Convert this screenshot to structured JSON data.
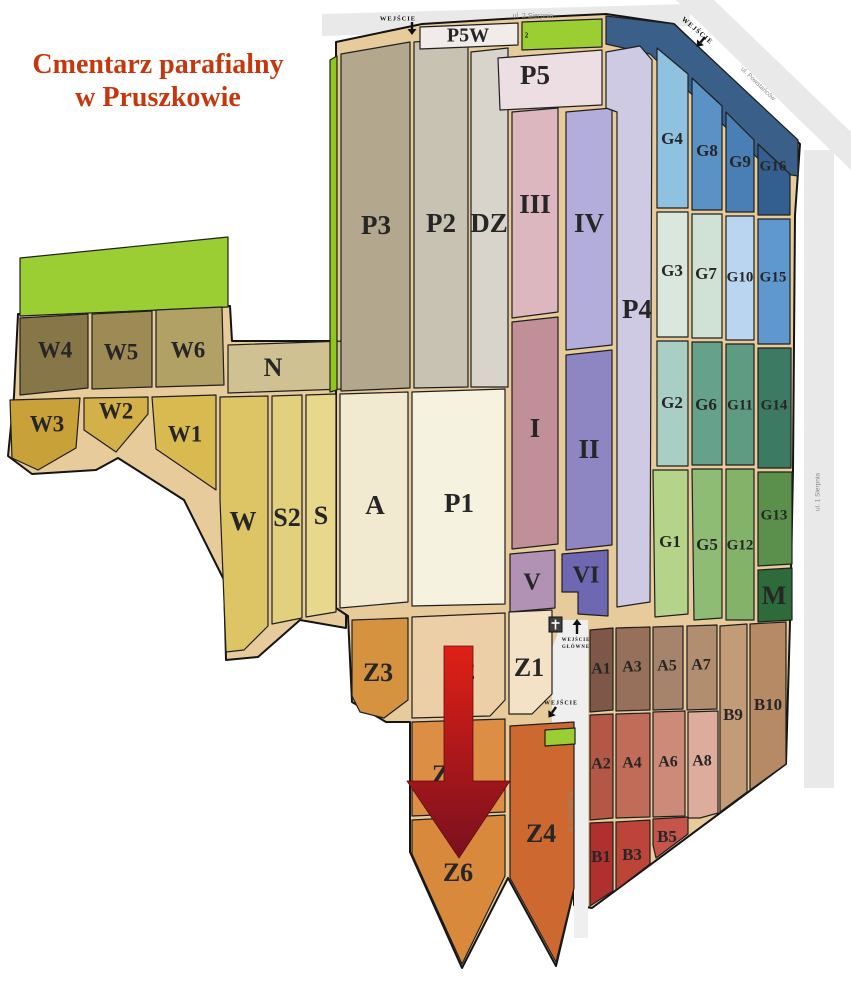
{
  "title": {
    "line1": "Cmentarz parafialny",
    "line2": "w Pruszkowie",
    "color": "#c5380e"
  },
  "map": {
    "road_color": "#e9e9e9",
    "inner_road_color": "#efefef",
    "path_color": "#e8cb9b",
    "outline_color": "#141414",
    "section_stroke": "#1f1f1f",
    "label_color": "#262626",
    "arrow_gradient": {
      "top": "#e02016",
      "bottom": "#7a101e"
    },
    "roads": [
      {
        "id": "2-sierpnia",
        "poly": "322,14 690,4 690,26 322,36"
      },
      {
        "id": "powstancow",
        "poly": "676,0 714,0 851,132 851,170"
      },
      {
        "id": "1-sierpnia",
        "poly": "804,150 834,150 834,788 804,788"
      }
    ],
    "inner_road": {
      "id": "cmentarna",
      "poly": "563,620 588,620 588,938 574,938 574,728 552,728 552,648"
    },
    "base": [
      {
        "id": "base-left-lobe",
        "poly": "14,396 18,314 230,306 232,341 346,341 346,628 300,620 258,657 226,660 224,580 184,500 118,458 96,470 32,474 8,456"
      },
      {
        "id": "base-main-lobe",
        "poly": "336,42 422,24 520,18 606,14 674,24 800,144 795,215 793,470 790,622 786,764 592,908 574,905 574,890 556,966 508,878 462,968 410,852 410,722 386,722 352,702 348,616 336,608"
      }
    ],
    "sections": [
      {
        "id": "green-west",
        "label": "",
        "poly": "20,258 228,237 228,307 20,316",
        "fill": "#9bce32"
      },
      {
        "id": "W4",
        "label": "W4",
        "poly": "20,318 88,314 88,388 20,395",
        "fill": "#877647",
        "lx": 55,
        "ly": 352,
        "fs": 23
      },
      {
        "id": "W5",
        "label": "W5",
        "poly": "92,314 152,311 152,387 92,389",
        "fill": "#9d8a54",
        "lx": 121,
        "ly": 354,
        "fs": 23
      },
      {
        "id": "W6",
        "label": "W6",
        "poly": "156,310 222,307 224,385 156,387",
        "fill": "#b1a164",
        "lx": 188,
        "ly": 352,
        "fs": 23
      },
      {
        "id": "N",
        "label": "N",
        "poly": "228,345 344,341 344,389 228,393",
        "fill": "#cfc191",
        "lx": 273,
        "ly": 370,
        "fs": 26
      },
      {
        "id": "W3",
        "label": "W3",
        "poly": "10,400 80,398 76,448 38,470 12,458",
        "fill": "#c8a138",
        "lx": 47,
        "ly": 426,
        "fs": 23
      },
      {
        "id": "W2",
        "label": "W2",
        "poly": "84,398 148,397 148,414 116,452 84,430",
        "fill": "#d3b048",
        "lx": 116,
        "ly": 413,
        "fs": 23
      },
      {
        "id": "W1",
        "label": "W1",
        "poly": "152,397 216,395 216,490 156,449",
        "fill": "#d9ba50",
        "lx": 185,
        "ly": 436,
        "fs": 23
      },
      {
        "id": "W",
        "label": "W",
        "poly": "220,397 268,396 268,626 244,650 226,652 220,500",
        "fill": "#ddc465",
        "lx": 243,
        "ly": 524,
        "fs": 27
      },
      {
        "id": "S2",
        "label": "S2",
        "poly": "272,396 302,395 302,618 272,624",
        "fill": "#e3d07c",
        "lx": 287,
        "ly": 520,
        "fs": 26
      },
      {
        "id": "S",
        "label": "S",
        "poly": "306,395 336,394 336,612 306,617",
        "fill": "#e8d88c",
        "lx": 321,
        "ly": 518,
        "fs": 26
      },
      {
        "id": "green-p3",
        "label": "",
        "poly": "330,60 337,56 337,390 330,392",
        "fill": "#8ec81e"
      },
      {
        "id": "P3",
        "label": "P3",
        "poly": "341,54 410,42 410,388 341,391",
        "fill": "#b3a88d",
        "lx": 376,
        "ly": 228,
        "fs": 27
      },
      {
        "id": "P2",
        "label": "P2",
        "poly": "414,42 468,38 468,387 414,388",
        "fill": "#c8c2b2",
        "lx": 441,
        "ly": 226,
        "fs": 27
      },
      {
        "id": "DZ",
        "label": "DZ",
        "poly": "471,52 508,48 508,387 471,387",
        "fill": "#d8d4cb",
        "lx": 489,
        "ly": 226,
        "fs": 27
      },
      {
        "id": "P5W",
        "label": "P5W",
        "poly": "420,27 518,23 518,45 420,49",
        "fill": "#f1ece9",
        "lx": 468,
        "ly": 37,
        "fs": 20
      },
      {
        "id": "P5",
        "label": "P5",
        "poly": "498,58 602,50 602,105 500,110",
        "fill": "#ecdee2",
        "lx": 535,
        "ly": 78,
        "fs": 27
      },
      {
        "id": "green-top",
        "label": "",
        "poly": "522,22 602,19 602,47 522,50",
        "fill": "#9bce32"
      },
      {
        "id": "navy-band",
        "label": "",
        "poly": "606,16 674,24 798,140 798,176 772,172 650,54 606,44",
        "fill": "#3a5f88"
      },
      {
        "id": "III",
        "label": "III",
        "poly": "512,112 558,108 558,312 512,318",
        "fill": "#dcb7bf",
        "lx": 535,
        "ly": 207,
        "fs": 27
      },
      {
        "id": "I",
        "label": "I",
        "poly": "512,322 558,317 558,544 512,549",
        "fill": "#c18f98",
        "lx": 535,
        "ly": 431,
        "fs": 27
      },
      {
        "id": "IV",
        "label": "IV",
        "poly": "566,112 612,108 612,345 566,350",
        "fill": "#b2adda",
        "lx": 589,
        "ly": 226,
        "fs": 27
      },
      {
        "id": "II",
        "label": "II",
        "poly": "566,355 612,350 612,545 566,550",
        "fill": "#8d86c2",
        "lx": 589,
        "ly": 452,
        "fs": 27
      },
      {
        "id": "P4",
        "label": "P4",
        "poly": "606,52 640,46 652,60 650,602 617,607 617,112 606,108",
        "fill": "#cecae4",
        "lx": 637,
        "ly": 312,
        "fs": 27
      },
      {
        "id": "V",
        "label": "V",
        "poly": "510,554 555,550 555,608 510,612",
        "fill": "#b191b4",
        "lx": 532,
        "ly": 584,
        "fs": 24
      },
      {
        "id": "VI",
        "label": "VI",
        "poly": "562,554 608,550 608,616 578,614 578,592 562,592",
        "fill": "#6e67b2",
        "lx": 586,
        "ly": 577,
        "fs": 24
      },
      {
        "id": "A",
        "label": "A",
        "poly": "340,394 408,392 408,602 340,608",
        "fill": "#f1ead0",
        "lx": 375,
        "ly": 508,
        "fs": 27
      },
      {
        "id": "P1",
        "label": "P1",
        "poly": "412,392 505,389 505,604 412,606",
        "fill": "#f6f2e0",
        "lx": 459,
        "ly": 506,
        "fs": 27
      },
      {
        "id": "G4",
        "label": "G4",
        "poly": "657,48 688,74 688,208 657,208",
        "fill": "#8fc1e1",
        "lx": 672,
        "ly": 140,
        "fs": 17
      },
      {
        "id": "G8",
        "label": "G8",
        "poly": "692,78 722,106 722,210 692,210",
        "fill": "#5a92c5",
        "lx": 707,
        "ly": 152,
        "fs": 17
      },
      {
        "id": "G9",
        "label": "G9",
        "poly": "726,112 754,140 754,212 726,212",
        "fill": "#4a7fb6",
        "lx": 740,
        "ly": 163,
        "fs": 17
      },
      {
        "id": "G16",
        "label": "G16",
        "poly": "758,144 790,174 790,215 758,215",
        "fill": "#335f90",
        "lx": 773,
        "ly": 167,
        "fs": 15
      },
      {
        "id": "G3",
        "label": "G3",
        "poly": "657,212 688,212 688,337 657,337",
        "fill": "#d9e7dd",
        "lx": 672,
        "ly": 272,
        "fs": 17
      },
      {
        "id": "G7",
        "label": "G7",
        "poly": "692,214 722,214 722,338 692,338",
        "fill": "#d0e1d5",
        "lx": 706,
        "ly": 275,
        "fs": 17
      },
      {
        "id": "G10",
        "label": "G10",
        "poly": "726,216 754,216 754,340 726,340",
        "fill": "#b9d5ef",
        "lx": 740,
        "ly": 278,
        "fs": 15
      },
      {
        "id": "G15",
        "label": "G15",
        "poly": "758,219 790,219 790,344 758,344",
        "fill": "#5f98ce",
        "lx": 773,
        "ly": 278,
        "fs": 15
      },
      {
        "id": "G2",
        "label": "G2",
        "poly": "657,341 688,341 688,466 657,466",
        "fill": "#a9cfc4",
        "lx": 672,
        "ly": 404,
        "fs": 17
      },
      {
        "id": "G6",
        "label": "G6",
        "poly": "692,342 722,342 722,465 692,465",
        "fill": "#66a18c",
        "lx": 706,
        "ly": 406,
        "fs": 17
      },
      {
        "id": "G11",
        "label": "G11",
        "poly": "726,344 754,344 754,465 726,465",
        "fill": "#5f9a83",
        "lx": 740,
        "ly": 406,
        "fs": 15
      },
      {
        "id": "G14",
        "label": "G14",
        "poly": "758,348 791,348 791,468 758,468",
        "fill": "#3d7a63",
        "lx": 774,
        "ly": 406,
        "fs": 15
      },
      {
        "id": "G1",
        "label": "G1",
        "poly": "653,470 688,470 688,614 655,617",
        "fill": "#b5d48a",
        "lx": 670,
        "ly": 543,
        "fs": 17
      },
      {
        "id": "G5",
        "label": "G5",
        "poly": "692,469 722,469 722,618 694,620",
        "fill": "#8fbc74",
        "lx": 707,
        "ly": 546,
        "fs": 17
      },
      {
        "id": "G12",
        "label": "G12",
        "poly": "726,469 754,469 754,620 726,620",
        "fill": "#83b369",
        "lx": 740,
        "ly": 546,
        "fs": 15
      },
      {
        "id": "G13",
        "label": "G13",
        "poly": "758,472 792,472 792,564 758,566",
        "fill": "#5a8f4c",
        "lx": 774,
        "ly": 516,
        "fs": 15
      },
      {
        "id": "M",
        "label": "M",
        "poly": "758,570 792,568 792,620 758,622",
        "fill": "#2e6b3b",
        "lx": 774,
        "ly": 598,
        "fs": 26
      },
      {
        "id": "A1",
        "label": "A1",
        "poly": "590,630 613,628 613,710 590,712",
        "fill": "#7e5749",
        "lx": 601,
        "ly": 670,
        "fs": 16
      },
      {
        "id": "A3",
        "label": "A3",
        "poly": "616,628 650,627 650,710 616,711",
        "fill": "#97705b",
        "lx": 632,
        "ly": 668,
        "fs": 16
      },
      {
        "id": "A5",
        "label": "A5",
        "poly": "653,627 683,626 683,709 653,710",
        "fill": "#a6836b",
        "lx": 667,
        "ly": 667,
        "fs": 16
      },
      {
        "id": "A7",
        "label": "A7",
        "poly": "687,626 717,625 717,709 687,710",
        "fill": "#b18e70",
        "lx": 701,
        "ly": 666,
        "fs": 16
      },
      {
        "id": "B9",
        "label": "B9",
        "poly": "720,626 747,624 747,792 720,812",
        "fill": "#c39b77",
        "lx": 733,
        "ly": 716,
        "fs": 17
      },
      {
        "id": "B10",
        "label": "B10",
        "poly": "750,624 786,622 786,764 750,790",
        "fill": "#b68a64",
        "lx": 768,
        "ly": 706,
        "fs": 17
      },
      {
        "id": "A2",
        "label": "A2",
        "poly": "590,715 613,714 613,818 590,820",
        "fill": "#b55747",
        "lx": 601,
        "ly": 765,
        "fs": 16
      },
      {
        "id": "A4",
        "label": "A4",
        "poly": "616,714 650,713 650,817 616,818",
        "fill": "#c16c59",
        "lx": 632,
        "ly": 764,
        "fs": 16
      },
      {
        "id": "A6",
        "label": "A6",
        "poly": "653,712 685,711 685,816 653,817",
        "fill": "#ce8a78",
        "lx": 668,
        "ly": 763,
        "fs": 16
      },
      {
        "id": "A8",
        "label": "A8",
        "poly": "688,712 718,711 718,813 700,818 688,818",
        "fill": "#ddac9c",
        "lx": 702,
        "ly": 762,
        "fs": 16
      },
      {
        "id": "B1",
        "label": "B1",
        "poly": "590,823 613,822 613,891 590,906",
        "fill": "#b02f2f",
        "lx": 601,
        "ly": 858,
        "fs": 17
      },
      {
        "id": "B3",
        "label": "B3",
        "poly": "616,822 650,820 650,864 616,890",
        "fill": "#bc4439",
        "lx": 632,
        "ly": 856,
        "fs": 17
      },
      {
        "id": "B5",
        "label": "B5",
        "poly": "653,819 688,817 688,834 656,858 653,845",
        "fill": "#c5544a",
        "lx": 667,
        "ly": 838,
        "fs": 17
      },
      {
        "id": "Z3",
        "label": "Z3",
        "poly": "352,620 408,618 408,700 384,718 360,712 352,696",
        "fill": "#d6933f",
        "lx": 378,
        "ly": 675,
        "fs": 26
      },
      {
        "id": "Z2",
        "label": "Z2",
        "poly": "412,617 505,613 505,700 490,716 412,718",
        "fill": "#eccfa7",
        "lx": 460,
        "ly": 673,
        "fs": 26
      },
      {
        "id": "Z1",
        "label": "Z1",
        "poly": "509,612 552,610 552,694 532,714 509,714",
        "fill": "#f3e2c6",
        "lx": 529,
        "ly": 670,
        "fs": 26
      },
      {
        "id": "Z5",
        "label": "Z5",
        "poly": "412,722 505,719 505,812 412,816",
        "fill": "#dd8e45",
        "lx": 447,
        "ly": 777,
        "fs": 26
      },
      {
        "id": "Z6",
        "label": "Z6",
        "poly": "412,820 505,815 505,876 462,964 412,854",
        "fill": "#d8893c",
        "lx": 458,
        "ly": 875,
        "fs": 26
      },
      {
        "id": "Z4",
        "label": "Z4",
        "poly": "510,726 574,722 574,888 556,962 510,878",
        "fill": "#cd6930",
        "lx": 541,
        "ly": 836,
        "fs": 26
      },
      {
        "id": "green-gate",
        "label": "",
        "poly": "545,730 575,728 575,744 545,746",
        "fill": "#9bce32"
      }
    ],
    "street_labels": [
      {
        "id": "label-2-sierpnia",
        "text": "ul. 2 Sierpnia",
        "x": 533,
        "y": 16,
        "rot": 0,
        "fs": 7
      },
      {
        "id": "label-powstancow",
        "text": "ul. Powstańców",
        "x": 758,
        "y": 84,
        "rot": 44,
        "fs": 6.5
      },
      {
        "id": "label-1-sierpnia",
        "text": "ul. 1 Sierpnia",
        "x": 818,
        "y": 492,
        "rot": -90,
        "fs": 6.5
      },
      {
        "id": "label-cmentarna",
        "text": "ul. Cmentarna",
        "x": 571,
        "y": 812,
        "rot": -90,
        "fs": 6.5
      }
    ],
    "entrances": [
      {
        "id": "north-gate",
        "text": "WEJŚCIE",
        "x": 398,
        "y": 19,
        "rot": 0,
        "fs": 6.5,
        "arrow": {
          "x": 412,
          "y": 22,
          "rot": 0,
          "len": 13
        }
      },
      {
        "id": "ne-gate",
        "text": "WEJŚCIE",
        "x": 697,
        "y": 31,
        "rot": 40,
        "fs": 7,
        "arrow": {
          "x": 705,
          "y": 37,
          "rot": 40,
          "len": 13
        }
      },
      {
        "id": "main-gate-l1",
        "text": "WEJŚCIE",
        "x": 576,
        "y": 640,
        "rot": 0,
        "fs": 4.8,
        "arrow": {
          "x": 577,
          "y": 634,
          "rot": 180,
          "len": 15
        }
      },
      {
        "id": "main-gate-l2",
        "text": "GŁÓWNE",
        "x": 576,
        "y": 647,
        "rot": 0,
        "fs": 4.8
      },
      {
        "id": "south-gate",
        "text": "WEJŚCIE",
        "x": 561,
        "y": 703,
        "rot": 0,
        "fs": 6,
        "arrow": {
          "x": 556,
          "y": 707,
          "rot": 35,
          "len": 13
        }
      }
    ],
    "chapel": {
      "x": 549,
      "y": 617,
      "w": 13,
      "h": 15,
      "fill": "#3f3f3f",
      "cross_color": "#ffffff"
    },
    "big_arrow": {
      "poly": "444,646 473,646 473,781 510,781 459,858 407,781 444,781"
    },
    "marker2": {
      "text": "2",
      "x": 527,
      "y": 36,
      "color": "#cc0000",
      "fs": 7
    }
  }
}
